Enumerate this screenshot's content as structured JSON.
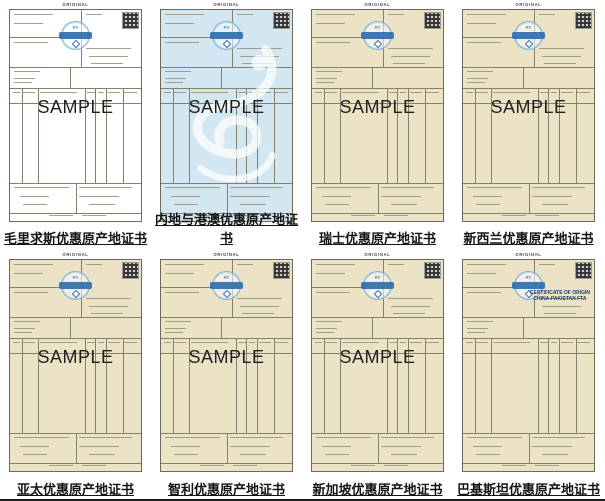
{
  "page": {
    "background": "#ffffff",
    "bottom_rule_color": "#1c1c1c"
  },
  "colors": {
    "white_paper": "#ffffff",
    "blue_paper": "#d2e7f2",
    "beige_paper": "#ece3c7",
    "seal_ring": "#7fb3d6",
    "seal_band": "#2f6fb0",
    "form_line": "#85806c",
    "caption_text": "#141414"
  },
  "labels": {
    "original": "ORIGINAL",
    "sample": "SAMPLE"
  },
  "seal": {
    "logo": "KC"
  },
  "certificates": [
    {
      "caption": "毛里求斯优惠原产地证书",
      "paper": "white_paper",
      "sample": true,
      "dragon_watermark": false,
      "title_lines": []
    },
    {
      "caption": "内地与港澳优惠原产地证书",
      "paper": "blue_paper",
      "sample": true,
      "dragon_watermark": true,
      "title_lines": []
    },
    {
      "caption": "瑞士优惠原产地证书",
      "paper": "beige_paper",
      "sample": true,
      "dragon_watermark": false,
      "title_lines": []
    },
    {
      "caption": "新西兰优惠原产地证书",
      "paper": "beige_paper",
      "sample": true,
      "dragon_watermark": false,
      "title_lines": []
    },
    {
      "caption": "亚太优惠原产地证书",
      "paper": "beige_paper",
      "sample": true,
      "dragon_watermark": false,
      "title_lines": []
    },
    {
      "caption": "智利优惠原产地证书",
      "paper": "beige_paper",
      "sample": true,
      "dragon_watermark": false,
      "title_lines": []
    },
    {
      "caption": "新加坡优惠原产地证书",
      "paper": "beige_paper",
      "sample": true,
      "dragon_watermark": false,
      "title_lines": []
    },
    {
      "caption": "巴基斯坦优惠原产地证书",
      "paper": "beige_paper",
      "sample": false,
      "dragon_watermark": false,
      "title_lines": [
        "CERTIFICATE OF ORIGIN",
        "CHINA-PAKISTAN FTA"
      ]
    }
  ]
}
